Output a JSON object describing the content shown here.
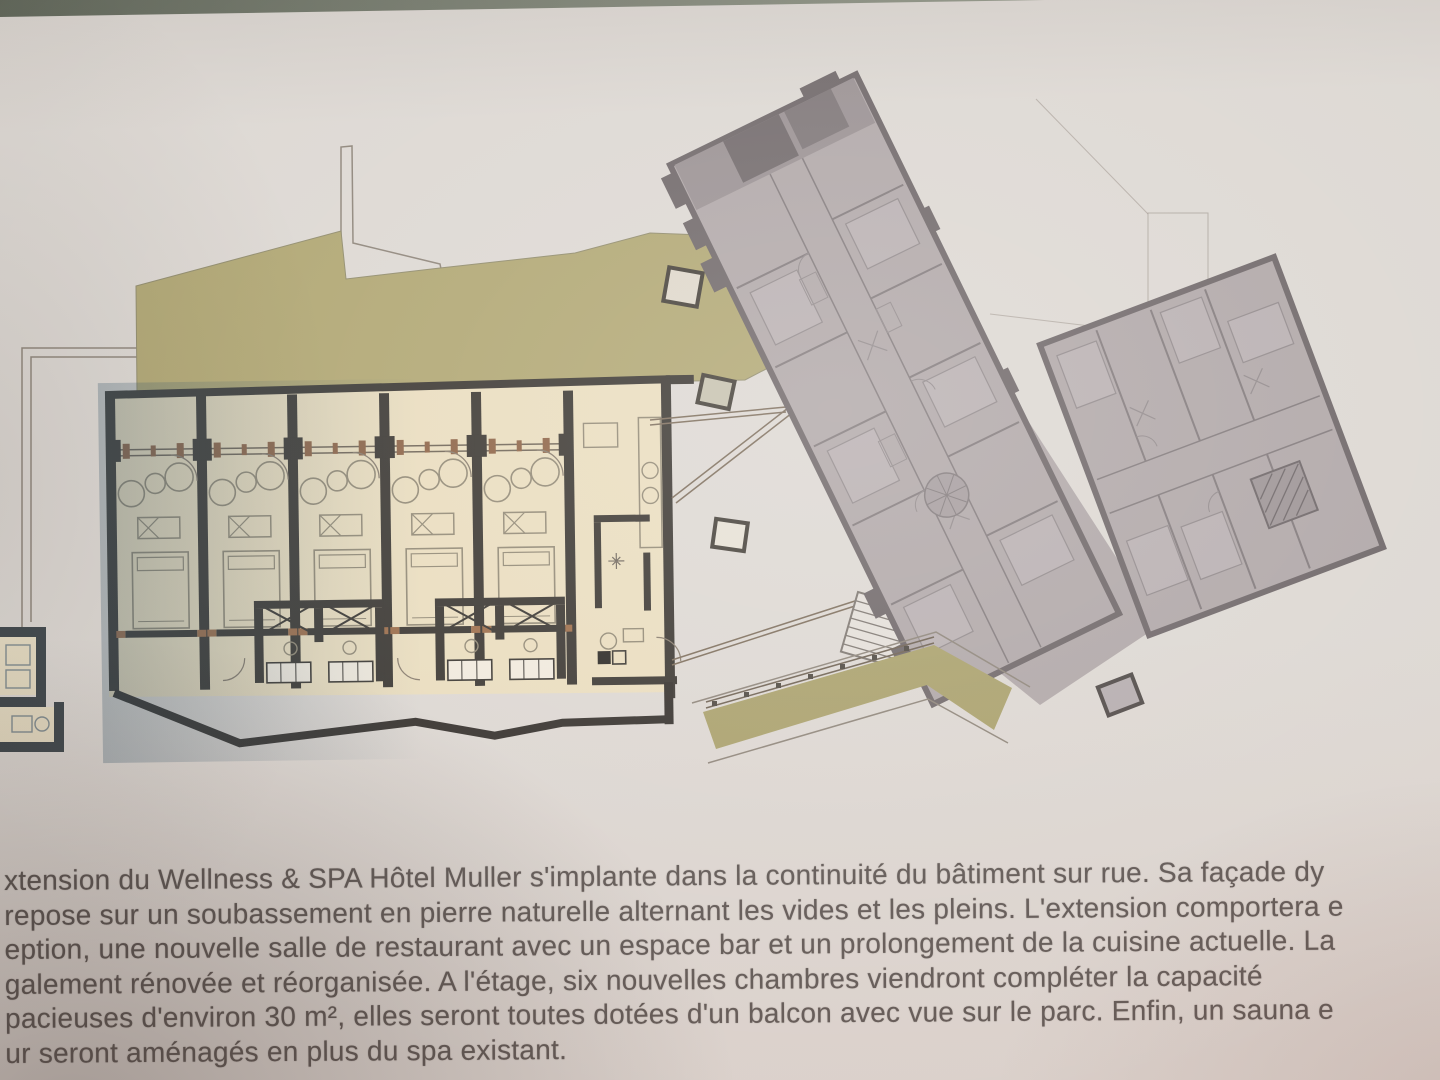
{
  "document": {
    "type_note": "photographed architectural floor-plan page, Wellness & SPA Hotel Muller extension",
    "description_lines": [
      "xtension du Wellness & SPA Hôtel Muller s'implante dans la continuité du bâtiment sur rue. Sa façade dy",
      "repose sur un soubassement en pierre naturelle alternant les vides et les pleins. L'extension comportera e",
      "eption, une nouvelle salle de restaurant avec un espace bar et un prolongement de la cuisine actuelle. La",
      "galement rénovée et réorganisée. A l'étage, six nouvelles chambres viendront compléter la capacité",
      "pacieuses d'environ 30 m², elles seront toutes dotées d'un balcon avec vue sur le parc. Enfin, un sauna e",
      "ur seront aménagés en plus du spa existant."
    ]
  },
  "colors": {
    "paper": "#dcd7d2",
    "photo_edge": "#69705f",
    "terrace_green": "#aea46f",
    "walkway_green": "#a79e68",
    "room_cream": "#e9dcbd",
    "room_wall_dark": "#36322d",
    "railing_brown": "#8a5f41",
    "furniture_line": "#8f8672",
    "existing_grey": "#aea5a6",
    "existing_wall": "#6b6365",
    "outline_thin": "#8b8277",
    "text": "#56504d"
  }
}
